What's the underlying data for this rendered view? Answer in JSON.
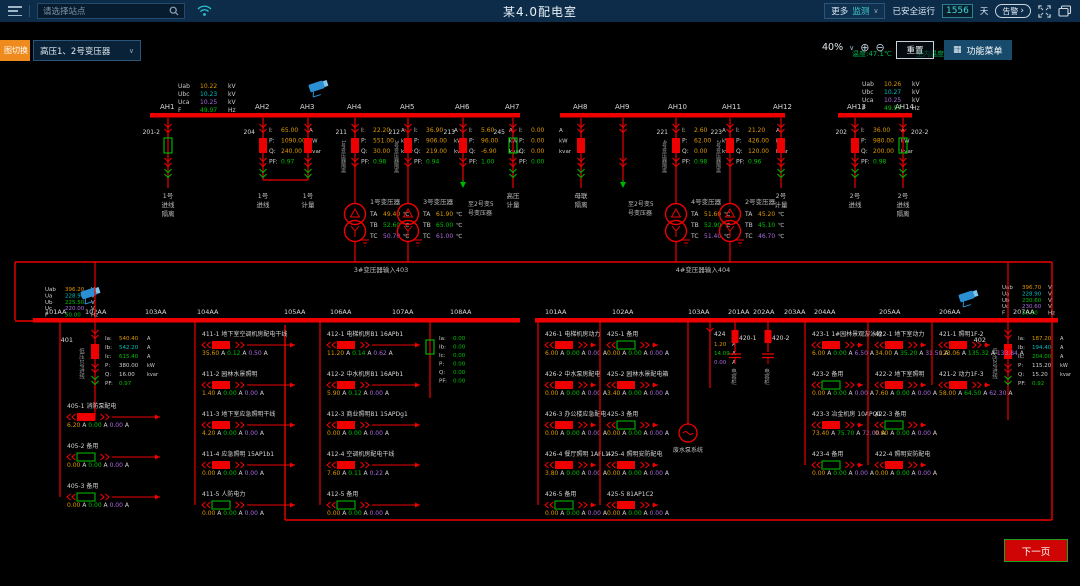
{
  "header": {
    "search_placeholder": "请选择站点",
    "title": "某4.0配电室",
    "more_monitor_1": "更多",
    "more_monitor_2": "监测",
    "safe_run_label": "已安全运行",
    "safe_run_days": "1556",
    "day_unit": "天",
    "alarm_label": "告警"
  },
  "toolbar": {
    "tab_label": "图切换",
    "transformer_select": "高压1、2号变压器",
    "zoom_percent": "40%",
    "reset_label": "重置",
    "menu_label": "功能菜单",
    "temp_outdoor": "温度:47.1℃",
    "temp_indoor": "室内温度: 29.09 ℃"
  },
  "footer": {
    "next_page": "下一页"
  },
  "colors": {
    "red": "#ee0000",
    "green": "#00b400",
    "text": "#cfcfcf",
    "dim": "#b0b0b0",
    "orange": "#dd9900",
    "teal": "#00bebe",
    "purple": "#aa6adf",
    "vgreen": "#00c000",
    "camera": "#2b8fd4"
  },
  "diagram": {
    "hv_voltage_blocks": [
      {
        "x": 178,
        "y": 88,
        "rows": [
          [
            "Uab",
            "10.22",
            "kV"
          ],
          [
            "Ubc",
            "10.23",
            "kV"
          ],
          [
            "Uca",
            "10.25",
            "kV"
          ],
          [
            "F",
            "49.97",
            "Hz"
          ]
        ]
      },
      {
        "x": 862,
        "y": 86,
        "rows": [
          [
            "Uab",
            "10.26",
            "kV"
          ],
          [
            "Ubc",
            "10.27",
            "kV"
          ],
          [
            "Uca",
            "10.25",
            "kV"
          ],
          [
            "F",
            "49.97",
            "Hz"
          ]
        ]
      }
    ],
    "lv_voltage_blocks": [
      {
        "x": 45,
        "y": 291,
        "rows": [
          [
            "Uab",
            "396.20",
            "V"
          ],
          [
            "Ua",
            "228.90",
            "V"
          ],
          [
            "Ub",
            "225.50",
            "V"
          ],
          [
            "Uc",
            "220.00",
            "V"
          ],
          [
            "F",
            "50.00",
            "Hz"
          ]
        ]
      },
      {
        "x": 1002,
        "y": 289,
        "rows": [
          [
            "Uab",
            "396.70",
            "V"
          ],
          [
            "Ua",
            "228.90",
            "V"
          ],
          [
            "Ub",
            "230.60",
            "V"
          ],
          [
            "Uc",
            "230.60",
            "V"
          ],
          [
            "F",
            "50.00",
            "Hz"
          ]
        ]
      }
    ],
    "cameras": [
      {
        "x": 318,
        "y": 86
      },
      {
        "x": 90,
        "y": 293
      },
      {
        "x": 968,
        "y": 296
      }
    ],
    "hv_buses": [
      {
        "x1": 150,
        "x2": 300,
        "labels": [
          [
            "AH1",
            160
          ],
          [
            "AH2",
            255
          ]
        ]
      },
      {
        "x1": 293,
        "x2": 520,
        "labels": [
          [
            "AH3",
            300
          ],
          [
            "AH4",
            347
          ],
          [
            "AH5",
            400
          ],
          [
            "AH6",
            455
          ],
          [
            "AH7",
            505
          ]
        ]
      },
      {
        "x1": 560,
        "x2": 785,
        "labels": [
          [
            "AH8",
            573
          ],
          [
            "AH9",
            615
          ],
          [
            "AH10",
            668
          ],
          [
            "AH11",
            722
          ],
          [
            "AH12",
            773
          ]
        ]
      },
      {
        "x1": 838,
        "x2": 912,
        "labels": [
          [
            "AH13",
            847
          ],
          [
            "AH14",
            895
          ]
        ]
      }
    ],
    "hv_feeders": [
      {
        "x": 168,
        "type": "disc-green",
        "side": "201-2",
        "sideAlign": "left",
        "bottom": [
          "1号",
          "进线",
          "隔离"
        ]
      },
      {
        "x": 263,
        "type": "breaker",
        "side": "204",
        "sideAlign": "left",
        "meas": {
          "I": "65.00",
          "P": "1090.00",
          "Q": "240.00",
          "PF": "0.97"
        },
        "endY": 180,
        "bottom": [
          "1号",
          "进线"
        ]
      },
      {
        "x": 308,
        "type": "breaker",
        "endY": 180,
        "bottom": [
          "1号",
          "计量"
        ]
      },
      {
        "x": 355,
        "type": "breaker",
        "side": "211",
        "sideAlign": "left",
        "vside": "1号变压器隔离",
        "meas": {
          "I": "22.20",
          "P": "551.00",
          "Q": "30.00",
          "PF": "0.98"
        },
        "to_tx": 0
      },
      {
        "x": 408,
        "type": "breaker",
        "side": "212",
        "sideAlign": "left",
        "vside": "3号变压器隔离",
        "meas": {
          "I": "36.90",
          "P": "906.00",
          "Q": "219.00",
          "PF": "0.94"
        },
        "to_tx": 1
      },
      {
        "x": 463,
        "type": "breaker",
        "side": "213",
        "sideAlign": "left",
        "meas": {
          "I": "5.60",
          "P": "96.00",
          "Q": "-6.90",
          "PF": "1.00"
        },
        "arrow": true,
        "atext": [
          "至2号变5",
          "号变压器"
        ]
      },
      {
        "x": 513,
        "type": "breaker-open",
        "side": "245",
        "sideAlign": "left",
        "meas": {
          "I": "0.00",
          "P": "0.00",
          "Q": "0.00",
          "PF": "0.00"
        },
        "bottom": [
          "高压",
          "计量"
        ]
      },
      {
        "x": 581,
        "type": "breaker",
        "bottom": [
          "母联",
          "隔离"
        ]
      },
      {
        "x": 623,
        "type": "disc",
        "arrow": true,
        "atext": [
          "至2号变5",
          "号变压器"
        ]
      },
      {
        "x": 676,
        "type": "breaker",
        "side": "221",
        "sideAlign": "left",
        "vside": "4号变压器隔离",
        "meas": {
          "I": "2.60",
          "P": "62.00",
          "Q": "0.00",
          "PF": "0.98"
        },
        "to_tx": 2
      },
      {
        "x": 730,
        "type": "breaker",
        "side": "223",
        "sideAlign": "left",
        "vside": "2号变压器隔离",
        "meas": {
          "I": "21.20",
          "P": "426.00",
          "Q": "120.00",
          "PF": "0.96"
        },
        "to_tx": 3
      },
      {
        "x": 781,
        "type": "breaker",
        "bottom": [
          "2号",
          "计量"
        ]
      },
      {
        "x": 855,
        "type": "breaker",
        "side": "202",
        "sideAlign": "left",
        "meas": {
          "I": "36.00",
          "P": "980.00",
          "Q": "200.00",
          "PF": "0.98"
        },
        "bottom": [
          "2号",
          "进线"
        ]
      },
      {
        "x": 903,
        "type": "disc-green",
        "side": "202-2",
        "sideAlign": "right",
        "bottom": [
          "2号",
          "进线",
          "隔离"
        ]
      }
    ],
    "transformers": [
      {
        "x": 355,
        "name": "1号变压器",
        "TA": "49.40",
        "TB": "52.60",
        "TC": "50.70"
      },
      {
        "x": 408,
        "name": "3号变压器",
        "TA": "61.90",
        "TB": "65.00",
        "TC": "61.00"
      },
      {
        "x": 676,
        "name": "4号变压器",
        "TA": "51.60",
        "TB": "52.90",
        "TC": "51.40"
      },
      {
        "x": 730,
        "name": "2号变压器",
        "TA": "45.20",
        "TB": "45.10",
        "TC": "46.70"
      }
    ],
    "tx_input_labels": [
      {
        "x": 381,
        "y": 272,
        "text": "3#变压器输入403"
      },
      {
        "x": 703,
        "y": 272,
        "text": "4#变压器输入404"
      }
    ],
    "connector": {
      "hline_y": 262,
      "hline_x1": 15,
      "hline_x2": 1052,
      "bottom_y": 520,
      "bottom_x1": 285,
      "bottom_x2": 1052
    },
    "lv_buses": [
      {
        "x1": 33,
        "x2": 520,
        "labels": [
          [
            "101AA",
            45
          ],
          [
            "102AA",
            85
          ],
          [
            "103AA",
            145
          ],
          [
            "104AA",
            197
          ],
          [
            "105AA",
            284
          ],
          [
            "106AA",
            330
          ],
          [
            "107AA",
            392
          ],
          [
            "108AA",
            450
          ]
        ]
      },
      {
        "x1": 535,
        "x2": 1058,
        "labels": [
          [
            "101AA",
            545
          ],
          [
            "102AA",
            612
          ],
          [
            "103AA",
            688
          ],
          [
            "201AA",
            728
          ],
          [
            "202AA",
            753
          ],
          [
            "203AA",
            784
          ],
          [
            "204AA",
            814
          ],
          [
            "205AA",
            879
          ],
          [
            "206AA",
            939
          ],
          [
            "207AA",
            1013
          ]
        ]
      }
    ],
    "incomers": [
      {
        "x": 95,
        "label": "401",
        "vtext": "低压1号进线",
        "rows": [
          [
            "Ia",
            "540.40",
            "A"
          ],
          [
            "Ib",
            "542.20",
            "A"
          ],
          [
            "Ic",
            "615.40",
            "A"
          ],
          [
            "P",
            "380.00",
            "kW"
          ],
          [
            "Q",
            "16.00",
            "kvar"
          ],
          [
            "PF",
            "0.97",
            ""
          ]
        ]
      },
      {
        "x": 1008,
        "label": "402",
        "vtext": "低压2号进线",
        "rows": [
          [
            "Ia",
            "187.20",
            "A"
          ],
          [
            "Ib",
            "194.40",
            "A"
          ],
          [
            "Ic",
            "204.00",
            "A"
          ],
          [
            "P",
            "115.20",
            "kW"
          ],
          [
            "Q",
            "15.20",
            "kvar"
          ],
          [
            "PF",
            "0.92",
            ""
          ]
        ]
      }
    ],
    "columns": [
      {
        "line": 60,
        "y0": 408,
        "rlen": 100,
        "rows": [
          [
            "405-1 消防泵配电",
            "closed",
            [
              "6.20",
              "0.00",
              "0.00"
            ]
          ],
          [
            "405-2 备用",
            "open",
            [
              "0.00",
              "0.00",
              "0.00"
            ]
          ],
          [
            "405-3 备用",
            "open",
            [
              "0.00",
              "0.00",
              "0.00"
            ]
          ]
        ]
      },
      {
        "line": 195,
        "y0": 336,
        "rlen": 100,
        "rows": [
          [
            "411-1 地下室空调机房配电干线",
            "closed",
            [
              "35.60",
              "0.12",
              "0.50"
            ]
          ],
          [
            "411-2 园林水景照明",
            "closed",
            [
              "1.40",
              "0.00",
              "0.00"
            ]
          ],
          [
            "411-3 地下室应急照明干线",
            "closed",
            [
              "4.20",
              "0.00",
              "0.00"
            ]
          ],
          [
            "411-4 应急照明 15AP1b1",
            "closed",
            [
              "0.00",
              "0.00",
              "0.00"
            ]
          ],
          [
            "411-5 人防电力",
            "open",
            [
              "0.00",
              "0.00",
              "0.00"
            ]
          ]
        ]
      },
      {
        "line": 320,
        "y0": 336,
        "rlen": 100,
        "rows": [
          [
            "412-1 电梯机房B1 16APb1",
            "closed",
            [
              "11.20",
              "0.14",
              "0.62"
            ]
          ],
          [
            "412-2 中水机房B1 16APb1",
            "closed",
            [
              "5.90",
              "0.12",
              "0.00"
            ]
          ],
          [
            "412-3 商业照明B1 15APDg1",
            "closed",
            [
              "0.00",
              "0.00",
              "0.00"
            ]
          ],
          [
            "412-4 空调机房配电干线",
            "closed",
            [
              "7.60",
              "0.11",
              "0.22"
            ]
          ],
          [
            "412-5 备用",
            "open",
            [
              "0.00",
              "0.00",
              "0.00"
            ]
          ]
        ]
      },
      {
        "line": 538,
        "y0": 336,
        "rlen": 58,
        "rows": [
          [
            "426-1 电梯机房动力",
            "closed",
            [
              "6.00",
              "0.00",
              "0.00"
            ]
          ],
          [
            "426-2 中水泵房配电",
            "closed",
            [
              "0.00",
              "0.00",
              "0.00"
            ]
          ],
          [
            "426-3 办公楼应急配电",
            "closed",
            [
              "0.00",
              "0.00",
              "0.00"
            ]
          ],
          [
            "426-4 餐厅照明 1AFL1-2",
            "closed",
            [
              "3.80",
              "0.00",
              "0.00"
            ]
          ],
          [
            "426-5 备用",
            "open",
            [
              "0.00",
              "0.00",
              "0.00"
            ]
          ]
        ]
      },
      {
        "line": 600,
        "y0": 336,
        "rlen": 58,
        "rows": [
          [
            "425-1 备用",
            "open",
            [
              "0.00",
              "0.00",
              "0.00"
            ]
          ],
          [
            "425-2 园林水景配电箱",
            "closed",
            [
              "3.40",
              "0.00",
              "0.00"
            ]
          ],
          [
            "425-3 备用",
            "open",
            [
              "0.00",
              "0.00",
              "0.00"
            ]
          ],
          [
            "425-4 照明安防配电",
            "closed",
            [
              "0.00",
              "0.00",
              "0.00"
            ]
          ],
          [
            "425-5 81AP1C2",
            "closed",
            [
              "0.00",
              "0.00",
              "0.00"
            ]
          ]
        ]
      },
      {
        "line": 805,
        "y0": 336,
        "rlen": 58,
        "rows": [
          [
            "423-1 1#园林景观游泳池",
            "closed",
            [
              "6.00",
              "0.00",
              "6.50"
            ]
          ],
          [
            "423-2 备用",
            "open",
            [
              "0.00",
              "0.00",
              "0.00"
            ]
          ],
          [
            "423-3 冶金机房 10APQ1",
            "closed",
            [
              "73.40",
              "75.70",
              "72.00"
            ]
          ],
          [
            "423-4 备用",
            "open",
            [
              "0.00",
              "0.00",
              "0.00"
            ]
          ]
        ]
      },
      {
        "line": 868,
        "y0": 336,
        "rlen": 58,
        "rows": [
          [
            "422-1 地下室动力",
            "closed",
            [
              "34.00",
              "35.20",
              "31.50"
            ]
          ],
          [
            "422-2 地下室照明",
            "closed",
            [
              "7.60",
              "0.00",
              "0.00"
            ]
          ],
          [
            "422-3 备用",
            "open",
            [
              "0.00",
              "0.00",
              "0.00"
            ]
          ],
          [
            "422-4 照明安防配电",
            "closed",
            [
              "0.00",
              "0.00",
              "0.00"
            ]
          ]
        ]
      },
      {
        "line": 932,
        "y0": 336,
        "rlen": 58,
        "rows": [
          [
            "421-1 照明1F-2",
            "closed",
            [
              "123.06",
              "135.32",
              "133.84"
            ]
          ],
          [
            "421-2 动力1F-3",
            "closed",
            [
              "58.00",
              "64.50",
              "62.30"
            ]
          ]
        ]
      }
    ],
    "tie_zero": {
      "x": 430,
      "rows": [
        [
          "Ia",
          "0.00"
        ],
        [
          "Ib",
          "0.00"
        ],
        [
          "Ic",
          "0.00"
        ],
        [
          "P",
          "0.00"
        ],
        [
          "Q",
          "0.00"
        ],
        [
          "PF",
          "0.00"
        ]
      ]
    },
    "capacitors": [
      {
        "x": 735,
        "label": "420-1",
        "vtext": "电容柜"
      },
      {
        "x": 768,
        "label": "420-2",
        "vtext": "电容柜"
      }
    ],
    "feeder_424": {
      "x": 710,
      "label": "424",
      "currents": [
        "1.20",
        "14.09",
        "0.00"
      ]
    },
    "pump": {
      "x": 688,
      "label": "废水泵系统"
    }
  }
}
